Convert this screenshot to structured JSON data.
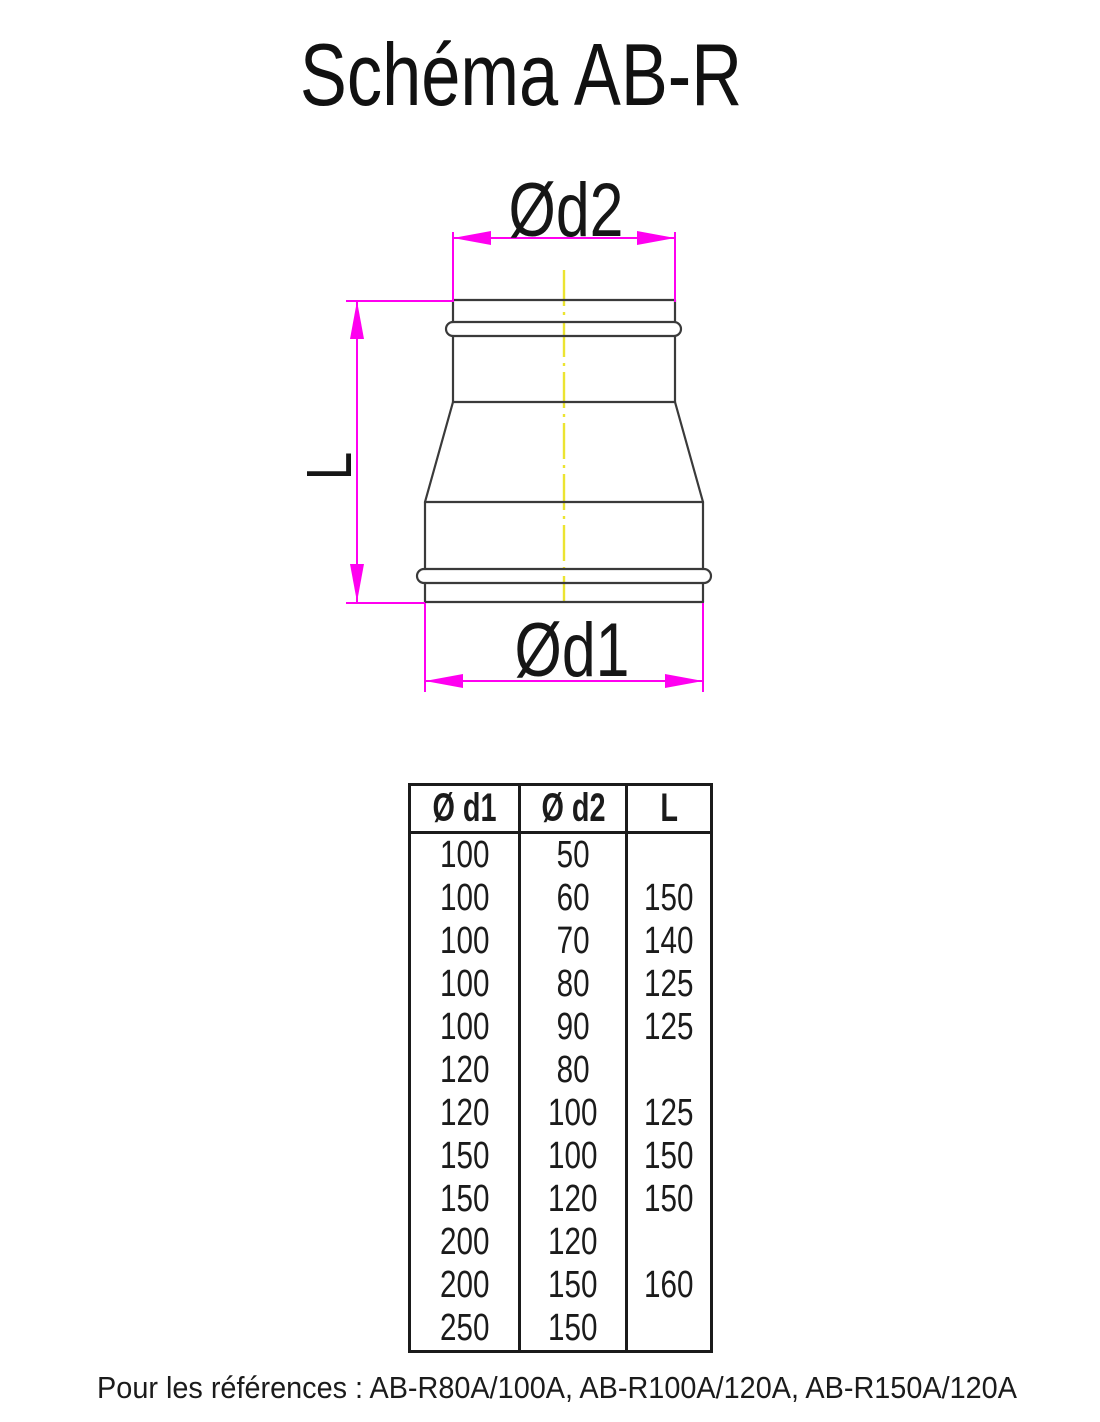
{
  "title": "Schéma AB-R",
  "diagram": {
    "labels": {
      "d2": "Ød2",
      "d1": "Ød1",
      "length": "L"
    },
    "colors": {
      "dimension_line": "#ff00f0",
      "centerline": "#ece431",
      "part_outline": "#3a3a3a"
    }
  },
  "table": {
    "headers": [
      "Ø d1",
      "Ø d2",
      "L"
    ],
    "rows": [
      [
        "100",
        "50",
        ""
      ],
      [
        "100",
        "60",
        "150"
      ],
      [
        "100",
        "70",
        "140"
      ],
      [
        "100",
        "80",
        "125"
      ],
      [
        "100",
        "90",
        "125"
      ],
      [
        "120",
        "80",
        ""
      ],
      [
        "120",
        "100",
        "125"
      ],
      [
        "150",
        "100",
        "150"
      ],
      [
        "150",
        "120",
        "150"
      ],
      [
        "200",
        "120",
        ""
      ],
      [
        "200",
        "150",
        "160"
      ],
      [
        "250",
        "150",
        ""
      ]
    ]
  },
  "footer": "Pour les références : AB-R80A/100A, AB-R100A/120A, AB-R150A/120A"
}
